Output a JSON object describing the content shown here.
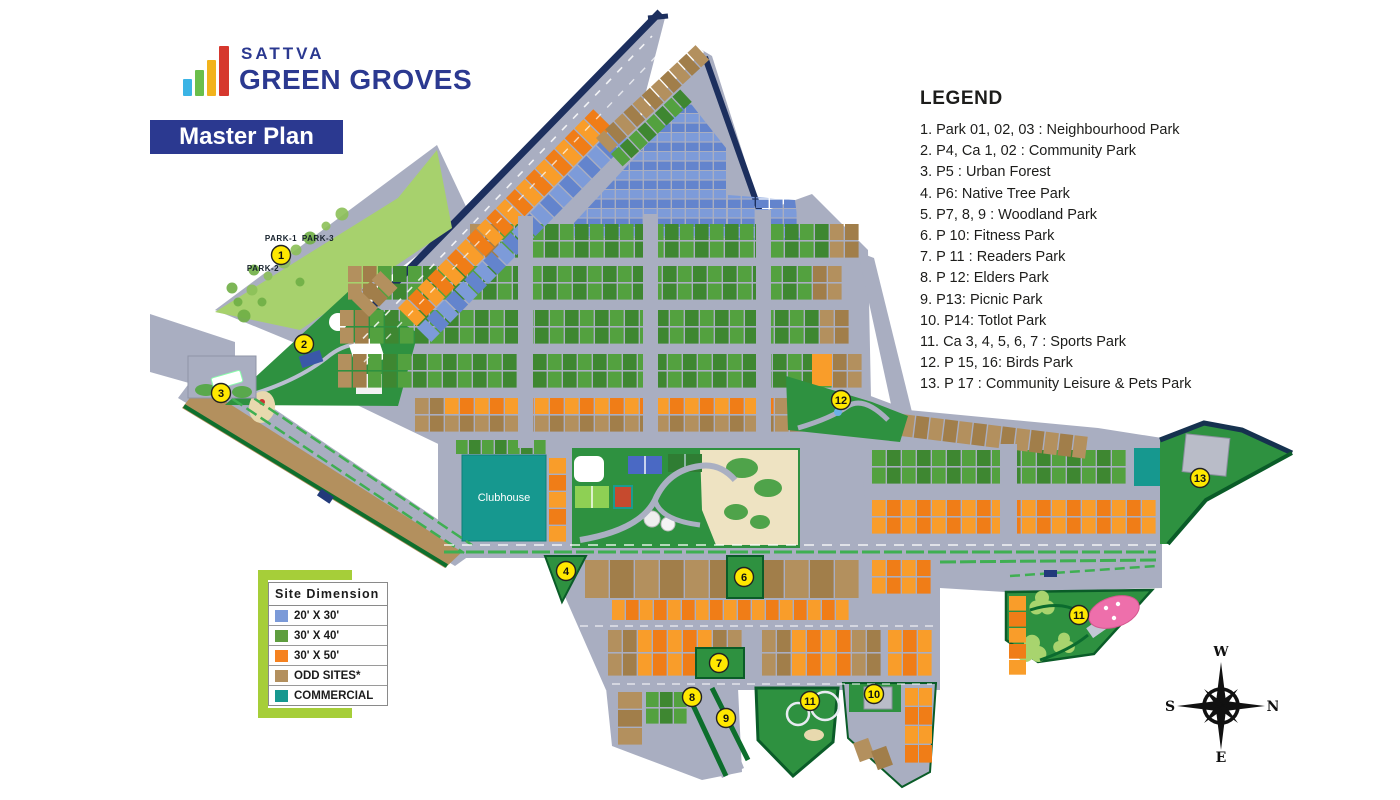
{
  "brand": {
    "name": "SATTVA",
    "product": "GREEN GROVES",
    "bar_colors": [
      "#3bb4e5",
      "#6abf4b",
      "#f2b31c",
      "#d6382e"
    ]
  },
  "page_title": "Master Plan",
  "legend": {
    "title": "LEGEND",
    "items": [
      "1. Park 01, 02, 03 : Neighbourhood Park",
      "2. P4, Ca 1, 02 : Community Park",
      "3. P5 : Urban Forest",
      "4. P6: Native Tree Park",
      "5. P7, 8, 9 : Woodland Park",
      "6. P 10: Fitness Park",
      "7. P 11 : Readers Park",
      "8. P 12: Elders Park",
      "9. P13: Picnic Park",
      "10. P14: Totlot Park",
      "11. Ca 3, 4, 5, 6, 7 : Sports Park",
      "12. P 15, 16: Birds Park",
      "13. P 17 : Community Leisure & Pets Park"
    ]
  },
  "site_dimension": {
    "title": "Site Dimension",
    "rows": [
      {
        "color": "#7b9ad8",
        "label": "20' X 30'"
      },
      {
        "color": "#5f9e3f",
        "label": "30' X 40'"
      },
      {
        "color": "#f58220",
        "label": "30' X 50'"
      },
      {
        "color": "#b3905e",
        "label": "ODD SITES*"
      },
      {
        "color": "#16988f",
        "label": "COMMERCIAL"
      }
    ]
  },
  "compass": {
    "top": "W",
    "right": "N",
    "left": "S",
    "bottom": "E"
  },
  "map": {
    "labels": {
      "clubhouse": "Clubhouse",
      "parks": [
        {
          "text": "PARK-1",
          "x": 281,
          "y": 241
        },
        {
          "text": "PARK-3",
          "x": 318,
          "y": 241
        },
        {
          "text": "PARK-2",
          "x": 263,
          "y": 271
        }
      ]
    },
    "markers": [
      {
        "n": "1",
        "x": 281,
        "y": 255
      },
      {
        "n": "2",
        "x": 304,
        "y": 344
      },
      {
        "n": "3",
        "x": 221,
        "y": 393
      },
      {
        "n": "4",
        "x": 566,
        "y": 571
      },
      {
        "n": "6",
        "x": 744,
        "y": 577
      },
      {
        "n": "7",
        "x": 719,
        "y": 663
      },
      {
        "n": "8",
        "x": 692,
        "y": 697
      },
      {
        "n": "9",
        "x": 726,
        "y": 718
      },
      {
        "n": "10",
        "x": 874,
        "y": 694
      },
      {
        "n": "11",
        "x": 810,
        "y": 701
      },
      {
        "n": "11",
        "x": 1079,
        "y": 615
      },
      {
        "n": "12",
        "x": 841,
        "y": 400
      },
      {
        "n": "13",
        "x": 1200,
        "y": 478
      }
    ],
    "colors": {
      "road": "#a9aec1",
      "navy": "#1c2f5e",
      "plot_blue": "#7d9bd9",
      "plot_blue_dark": "#6384cd",
      "plot_green": "#53a13f",
      "plot_green_dark": "#3e8731",
      "plot_orange": "#f99d2a",
      "plot_orange_dark": "#f07d17",
      "plot_brown": "#b3905e",
      "plot_brown_dark": "#a17e4a",
      "teal": "#16988f",
      "park_light": "#a7d16d",
      "park_mid": "#2e9140",
      "park_dark": "#157f38",
      "park_deep": "#0a5c28",
      "sand": "#eee3c2",
      "marker": "#ffe800",
      "pink": "#ee6fab",
      "building": "#b9bcc8",
      "median_green": "#3faf52"
    }
  }
}
